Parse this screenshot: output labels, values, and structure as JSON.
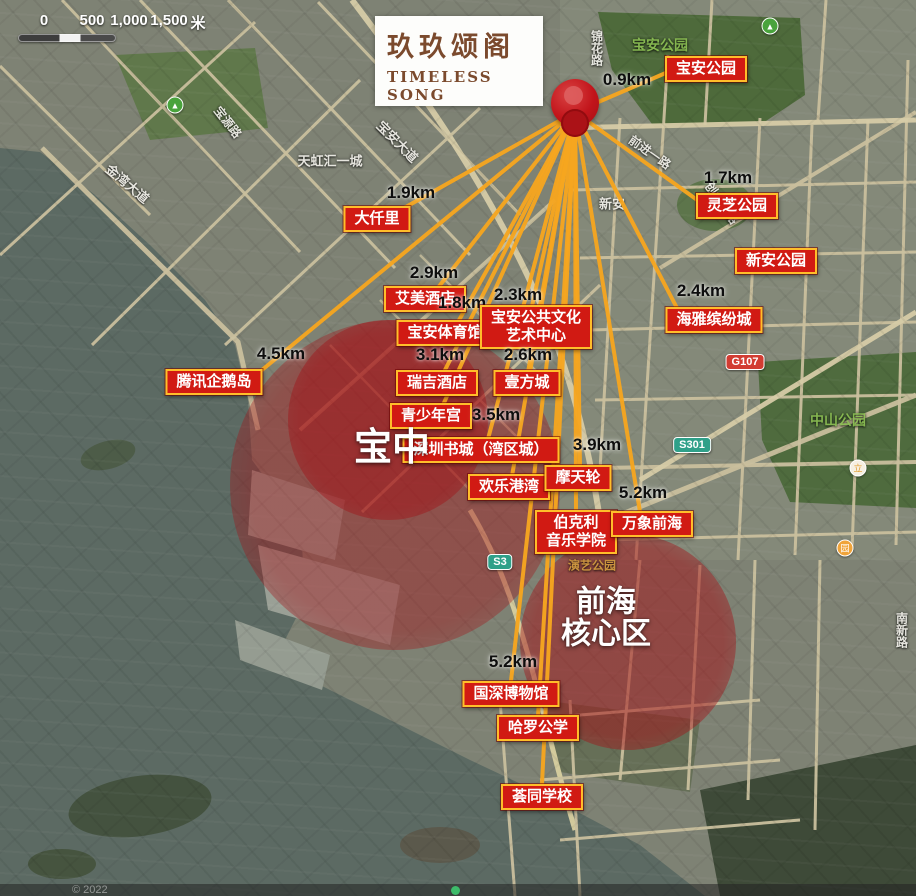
{
  "scale_bar": {
    "ticks": [
      {
        "t": "0",
        "x": 30
      },
      {
        "t": "500",
        "x": 78
      },
      {
        "t": "1,000",
        "x": 115
      },
      {
        "t": "1,500",
        "x": 155
      }
    ],
    "unit": "米",
    "unit_x": 184
  },
  "logo": {
    "title": "玖玖颂阁",
    "subtitle1": "TIMELESS",
    "subtitle2": "SONG"
  },
  "pin": {
    "x": 575,
    "y": 112
  },
  "region_labels": [
    {
      "id": "baozhong",
      "lines": [
        "宝中"
      ],
      "x": 392,
      "y": 449,
      "size": 38
    },
    {
      "id": "qianhai-core",
      "lines": [
        "前海",
        "核心区"
      ],
      "x": 606,
      "y": 618,
      "size": 30
    }
  ],
  "overlay_zones": [
    {
      "id": "baozhong-zone-inner",
      "x": 388,
      "y": 420,
      "r": 100,
      "alpha": 0.5
    },
    {
      "id": "baozhong-zone-outer",
      "x": 395,
      "y": 485,
      "r": 165,
      "alpha": 0.42
    },
    {
      "id": "qianhai-zone",
      "x": 628,
      "y": 642,
      "r": 108,
      "alpha": 0.5
    }
  ],
  "pois": [
    {
      "id": "baoan-park",
      "label": "宝安公园",
      "x": 706,
      "y": 69,
      "distance": "0.9km",
      "dx": 627,
      "dy": 80,
      "line": [
        668,
        72
      ]
    },
    {
      "id": "lingzhi-park",
      "label": "灵芝公园",
      "x": 737,
      "y": 206,
      "distance": "1.7km",
      "dx": 728,
      "dy": 178,
      "line": [
        700,
        202
      ]
    },
    {
      "id": "xinan-park",
      "label": "新安公园",
      "x": 776,
      "y": 261
    },
    {
      "id": "haiya-binfen",
      "label": "海雅缤纷城",
      "x": 714,
      "y": 320,
      "distance": "2.4km",
      "dx": 701,
      "dy": 291,
      "line": [
        678,
        310
      ]
    },
    {
      "id": "daqianli",
      "label": "大仟里",
      "x": 377,
      "y": 219,
      "distance": "1.9km",
      "dx": 411,
      "dy": 193,
      "line": [
        404,
        208
      ]
    },
    {
      "id": "aimei-hotel",
      "label": "艾美酒店",
      "x": 425,
      "y": 299,
      "distance": "2.9km",
      "dx": 434,
      "dy": 273,
      "line": [
        437,
        289
      ]
    },
    {
      "id": "baoan-stadium",
      "label": "宝安体育馆",
      "x": 445,
      "y": 333,
      "distance": "1.8km",
      "dx": 462,
      "dy": 303,
      "line": [
        458,
        322
      ]
    },
    {
      "id": "baoan-culture-center",
      "label": "宝安公共文化",
      "label2": "艺术中心",
      "x": 536,
      "y": 327,
      "distance": "2.3km",
      "dx": 518,
      "dy": 295,
      "line": [
        532,
        306
      ]
    },
    {
      "id": "ruiji-hotel",
      "label": "瑞吉酒店",
      "x": 437,
      "y": 383,
      "distance": "3.1km",
      "dx": 440,
      "dy": 355,
      "line": [
        444,
        372
      ]
    },
    {
      "id": "yifang-cheng",
      "label": "壹方城",
      "x": 527,
      "y": 383,
      "distance": "2.6km",
      "dx": 528,
      "dy": 355,
      "line": [
        528,
        372
      ]
    },
    {
      "id": "youth-palace",
      "label": "青少年宫",
      "x": 431,
      "y": 416,
      "line": [
        443,
        405
      ]
    },
    {
      "id": "shenzhen-book-city",
      "label": "深圳书城（湾区城）",
      "x": 481,
      "y": 450,
      "distance": "3.5km",
      "dx": 496,
      "dy": 415,
      "line": [
        488,
        439
      ]
    },
    {
      "id": "happy-harbor",
      "label": "欢乐港湾",
      "x": 509,
      "y": 487,
      "line": [
        512,
        476
      ]
    },
    {
      "id": "ferris-wheel",
      "label": "摩天轮",
      "x": 578,
      "y": 478,
      "distance": "3.9km",
      "dx": 597,
      "dy": 445,
      "line": [
        580,
        466
      ]
    },
    {
      "id": "berklee-music-school",
      "label": "伯克利",
      "label2": "音乐学院",
      "x": 576,
      "y": 532,
      "line": [
        576,
        511
      ]
    },
    {
      "id": "mixc-qianhai",
      "label": "万象前海",
      "x": 652,
      "y": 524,
      "distance": "5.2km",
      "dx": 643,
      "dy": 493,
      "line": [
        640,
        512
      ]
    },
    {
      "id": "tencent-penguin-island",
      "label": "腾讯企鹅岛",
      "x": 214,
      "y": 382,
      "distance": "4.5km",
      "dx": 281,
      "dy": 354,
      "line": [
        262,
        370
      ]
    },
    {
      "id": "guoshen-museum",
      "label": "国深博物馆",
      "x": 511,
      "y": 694,
      "distance": "5.2km",
      "dx": 513,
      "dy": 662,
      "line": [
        511,
        681
      ]
    },
    {
      "id": "harrow-school",
      "label": "哈罗公学",
      "x": 538,
      "y": 728,
      "line": [
        538,
        716
      ]
    },
    {
      "id": "whittle-school",
      "label": "荟同学校",
      "x": 542,
      "y": 797,
      "line": [
        542,
        784
      ]
    }
  ],
  "map_labels": [
    {
      "text": "宝安公园",
      "x": 660,
      "y": 45,
      "color": "#8abd52",
      "size": 14
    },
    {
      "text": "中山公园",
      "x": 838,
      "y": 420,
      "color": "#8abd52",
      "size": 14
    },
    {
      "text": "演艺公园",
      "x": 592,
      "y": 565,
      "color": "#cf9a3f",
      "size": 12
    },
    {
      "text": "金湾大道",
      "x": 128,
      "y": 183,
      "rot": 40,
      "size": 13
    },
    {
      "text": "宝源路",
      "x": 228,
      "y": 122,
      "rot": 52,
      "size": 12
    },
    {
      "text": "天虹汇一城",
      "x": 330,
      "y": 160,
      "size": 13
    },
    {
      "text": "宝安大道",
      "x": 398,
      "y": 141,
      "rot": 45,
      "size": 13
    },
    {
      "text": "锦花路",
      "x": 597,
      "y": 48,
      "size": 12,
      "vertical": true
    },
    {
      "text": "新安",
      "x": 612,
      "y": 203,
      "size": 13
    },
    {
      "text": "前进一路",
      "x": 650,
      "y": 152,
      "rot": 35,
      "size": 12
    },
    {
      "text": "创业二路",
      "x": 722,
      "y": 203,
      "rot": 55,
      "size": 12
    },
    {
      "text": "南新路",
      "x": 902,
      "y": 630,
      "size": 12,
      "vertical": true
    }
  ],
  "road_shields": [
    {
      "text": "G107",
      "x": 745,
      "y": 362,
      "bg": "#d23c32"
    },
    {
      "text": "S301",
      "x": 692,
      "y": 445,
      "bg": "#2fa089"
    },
    {
      "text": "S3",
      "x": 500,
      "y": 562,
      "bg": "#2fa089"
    }
  ],
  "poi_icons": [
    {
      "name": "park-icon",
      "glyph": "▲",
      "x": 175,
      "y": 105,
      "bg": "#49a33c",
      "fg": "#ffffff"
    },
    {
      "name": "park-icon",
      "glyph": "▲",
      "x": 770,
      "y": 26,
      "bg": "#49a33c",
      "fg": "#ffffff"
    },
    {
      "name": "culture-poi-icon",
      "glyph": "立",
      "x": 858,
      "y": 468,
      "bg": "#f6efe2",
      "fg": "#e09b2d"
    },
    {
      "name": "taoyuan-poi-icon",
      "glyph": "园",
      "x": 845,
      "y": 548,
      "bg": "#f0a43a",
      "fg": "#ffffff"
    }
  ],
  "attribution": {
    "text": "© 2022"
  },
  "colors": {
    "label_bg": "#d11a13",
    "label_border": "#ffbe2a",
    "ray": "#f6a51f",
    "distance_text": "#0e0e0e",
    "logo_brown": "#7b4a2d",
    "overlay_red": "#a30e14",
    "water": "#5c6a63",
    "land": "#7e8274"
  }
}
